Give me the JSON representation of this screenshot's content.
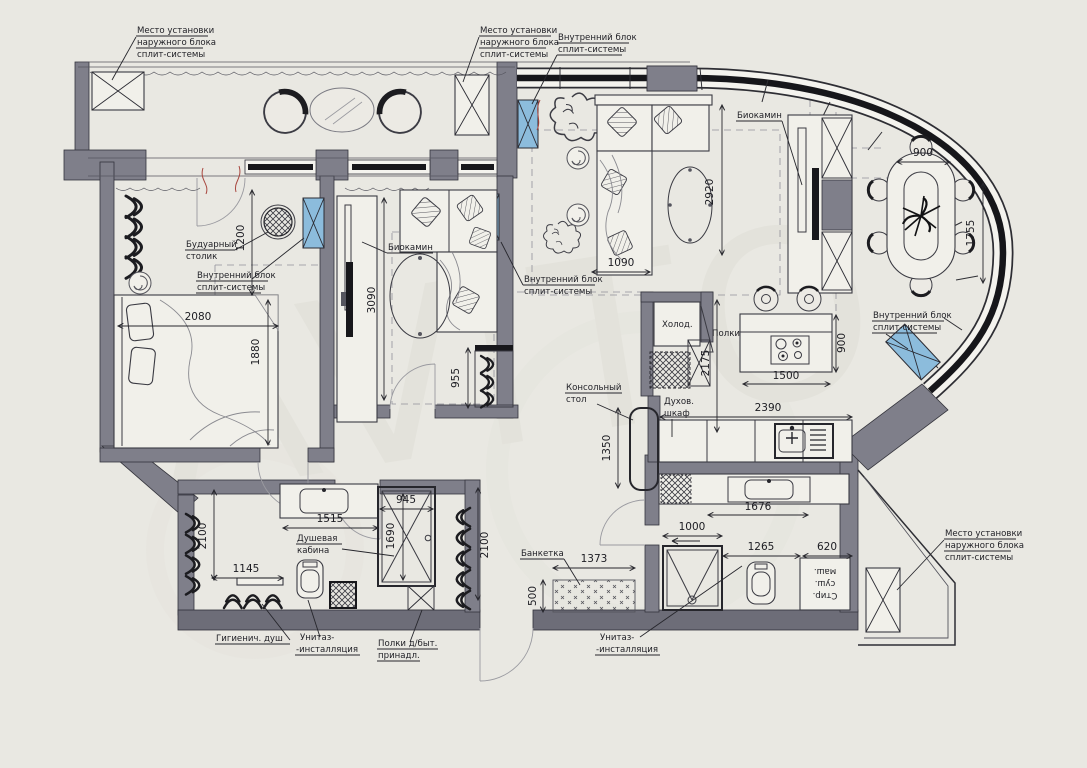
{
  "meta": {
    "type": "apartment-floor-plan",
    "language": "ru"
  },
  "colors": {
    "paper": "#e9e8e2",
    "wall_fill": "#7f7f8a",
    "wall_dark": "#6d6d78",
    "line": "#26262c",
    "ac_unit_blue": "#8cbcdc",
    "wire_red": "#a8473f",
    "watermark": "#dfded6"
  },
  "watermark": "AViTO",
  "labels": {
    "outdoor_unit": [
      "Место установки",
      "наружного блока",
      "сплит-системы"
    ],
    "indoor_unit": [
      "Внутренний блок",
      "сплит-системы"
    ],
    "biofireplace": "Биокамин",
    "boudoir_table": [
      "Будуарный",
      "столик"
    ],
    "fridge": "Холод.",
    "shelves": "Полки",
    "oven": [
      "Духов.",
      "шкаф"
    ],
    "console_table": [
      "Консольный",
      "стол"
    ],
    "bench": "Банкетка",
    "toilet_installation": [
      "Унитаз-",
      "-инсталляция"
    ],
    "washer_dryer": [
      "Стир.",
      "суш.",
      "маш."
    ],
    "hygienic_shower": "Гигиенич. душ",
    "household_shelves": [
      "Полки д/быт.",
      "принадл."
    ],
    "shower_cabin": [
      "Душевая",
      "кабина"
    ]
  },
  "dims": {
    "dining_width": "900",
    "dining_depth": "1755",
    "living_depth": "2920",
    "sofa_width": "1090",
    "boudoir_zone": "1200",
    "bed_width": "2080",
    "bed_zone_depth": "1880",
    "bedroom2_depth": "3090",
    "wardrobe_depth": "955",
    "kitchen_depth": "2175",
    "island_width": "1500",
    "island_depth": "900",
    "kitchen_run": "2390",
    "console_depth": "1350",
    "vanity_guest": "1676",
    "shower_guest": "1000",
    "toilet_guest_zone": "1265",
    "washer_zone": "620",
    "bench_width": "1373",
    "bench_depth": "500",
    "vanity_master": "1515",
    "shower_master_depth": "1690",
    "shower_master_width": "945",
    "rad_left": "2100",
    "rad_right": "2100",
    "hyg_zone": "1145"
  }
}
